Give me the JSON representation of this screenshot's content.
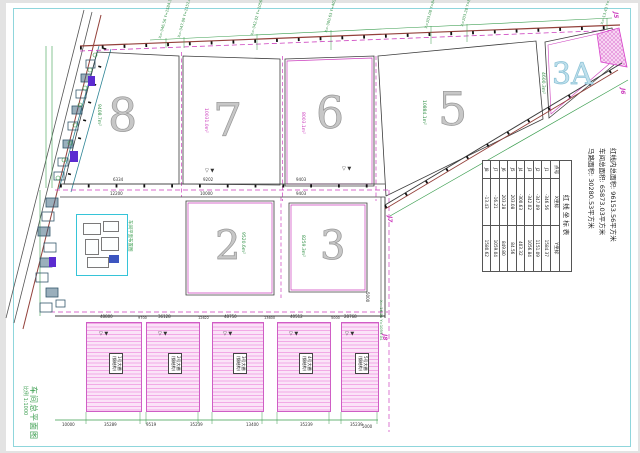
{
  "drawing_title": "车间总平面图",
  "scale_label": "比例 1:1000",
  "stats": {
    "line1": "红线内总面积: 96153.56平方米",
    "line2": "车间总面积: 65873.03平方米",
    "line3": "马路面积: 30280.53平方米"
  },
  "coord_table": {
    "title": "红线坐标表",
    "headers": [
      "点号",
      "X坐标",
      "Y坐标"
    ],
    "rows": [
      [
        "J1",
        "-346.56",
        "1584.37"
      ],
      [
        "J2",
        "-347.09",
        "1151.09"
      ],
      [
        "J3",
        "-342.02",
        "1056.84"
      ],
      [
        "J4",
        "-300.63",
        "403.32"
      ],
      [
        "J5",
        "203.08",
        "84.56"
      ],
      [
        "J6",
        "203.28",
        "849.80"
      ],
      [
        "J7",
        "-16.21",
        "1059.04"
      ],
      [
        "J8",
        "-13.43",
        "1580.62"
      ]
    ]
  },
  "plots": [
    {
      "id": "8",
      "area": "9408.7m²"
    },
    {
      "id": "7",
      "area": "10031.0m²"
    },
    {
      "id": "6",
      "area": "8003.1m²"
    },
    {
      "id": "5",
      "area": "10884.1m²"
    },
    {
      "id": "3A",
      "area": "4600.3m²"
    },
    {
      "id": "2",
      "area": "9520.6m²"
    },
    {
      "id": "3",
      "area": "8259.3m²"
    }
  ],
  "sheds": [
    {
      "label": "1号大棚",
      "sub": "(钢结构)",
      "width_dim": "48800"
    },
    {
      "label": "2号大棚",
      "sub": "(钢结构)",
      "width_dim": "36128"
    },
    {
      "label": "3号大棚",
      "sub": "(钢结构)",
      "width_dim": "48750"
    },
    {
      "label": "4号大棚",
      "sub": "(钢结构)",
      "width_dim": "40512"
    },
    {
      "label": "5号大棚",
      "sub": "(钢结构)",
      "width_dim": "28768"
    }
  ],
  "j_labels": {
    "j5": "J5",
    "j6": "J6",
    "j7": "J7",
    "j8": "J8"
  },
  "coord_callouts": [
    "X=-346.56 Y=1584.37",
    "X=-347.09 Y=1151.09",
    "X=-342.02 Y=1056.84",
    "X=-300.63 Y=403.32",
    "X=203.08 Y=84.56",
    "X=203.28 Y=849.80",
    "X=-16.21 Y=1059.04",
    "X=-13.43 Y=1580.62"
  ],
  "dims": {
    "shed_gaps": [
      "9700",
      "12622",
      "13600",
      "5000"
    ],
    "bottom": [
      "10000",
      "35289",
      "9519",
      "35239",
      "13400",
      "35239",
      "35239"
    ],
    "road_upper": [
      "6334",
      "9202",
      "9403"
    ],
    "road_lower": [
      "12200",
      "10000",
      "9403"
    ],
    "v5000": "5000",
    "level_mark": "▽ ▼"
  },
  "inset_label": "车间平面布置图"
}
